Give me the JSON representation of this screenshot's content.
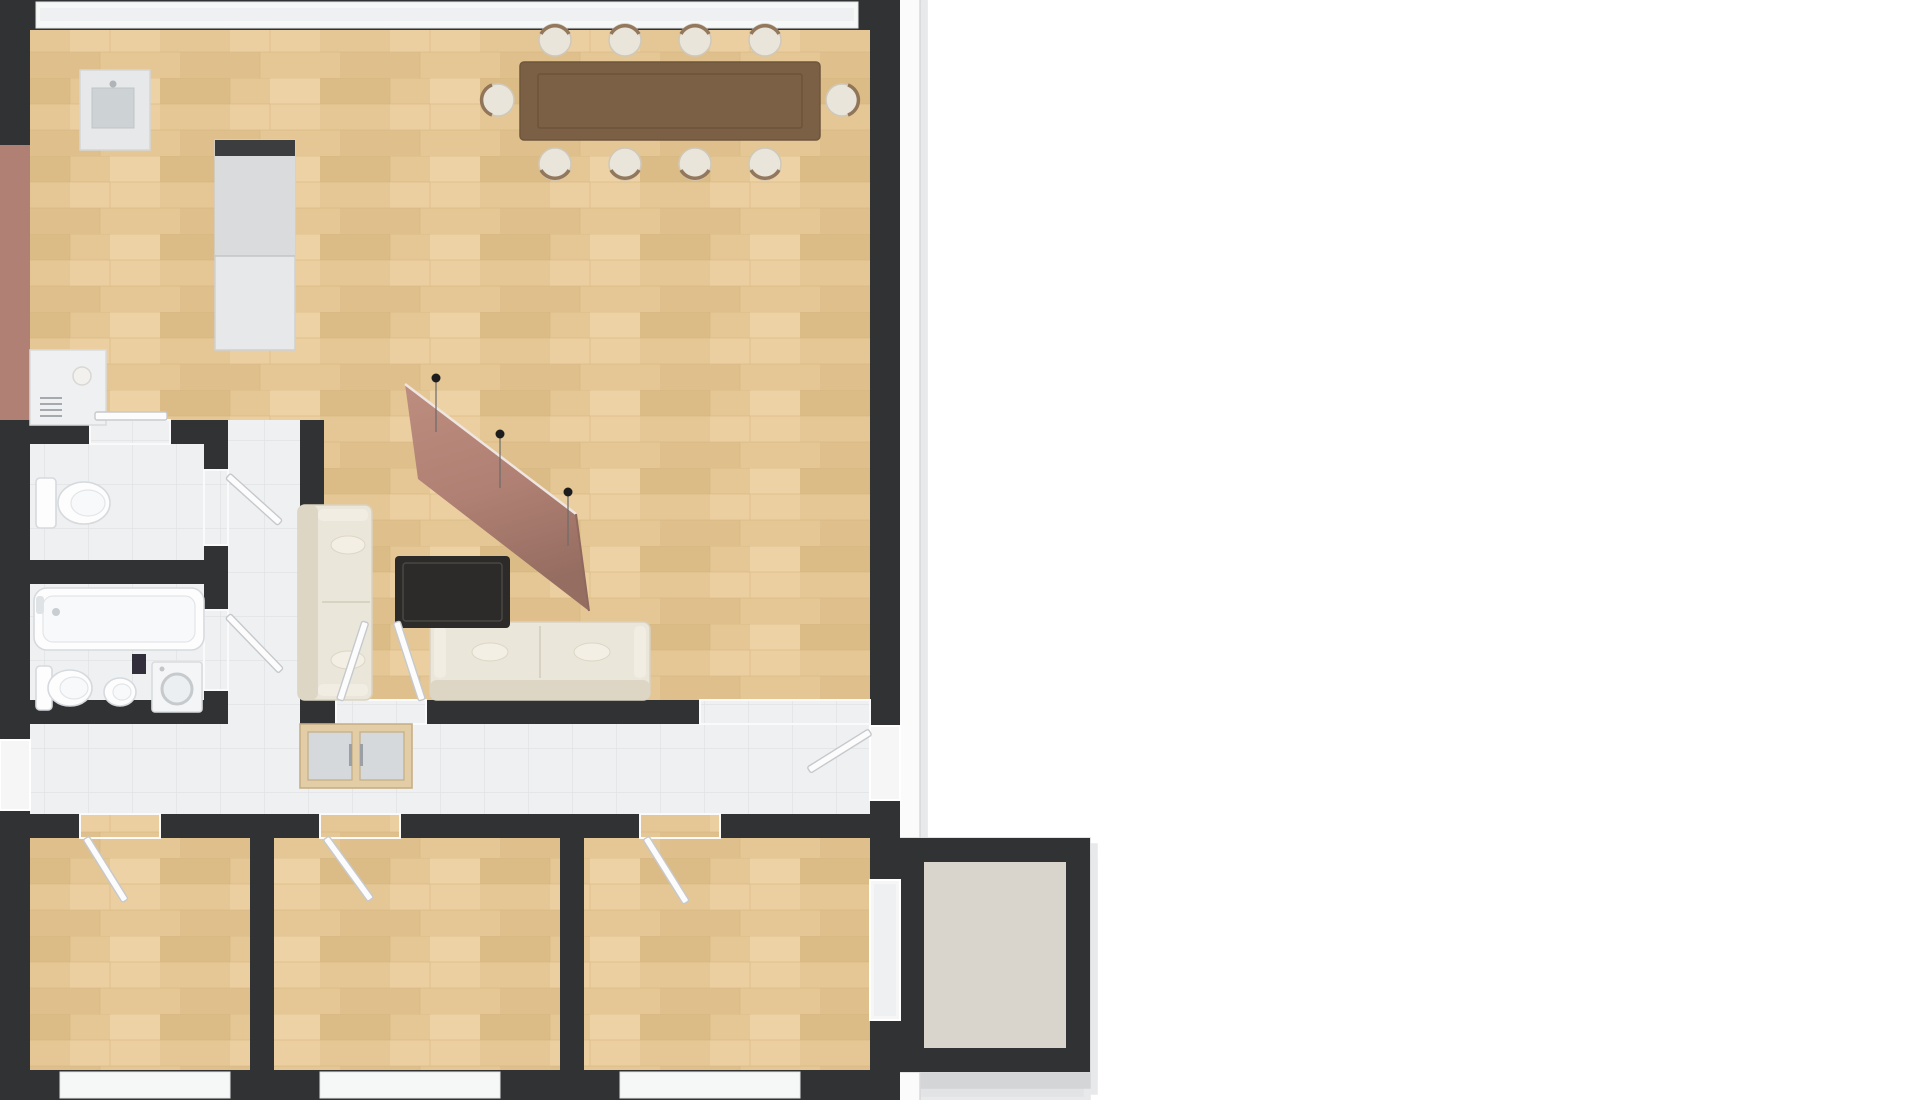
{
  "scene": {
    "kind": "3d-floor-plan-render",
    "view": "isometric aerial, rotated ~40deg, white background",
    "apartment": "3-bedroom apartment with open living-dining room, galley kitchen, bathroom, WC, hallway and balcony"
  },
  "colors": {
    "background": "#ffffff",
    "slab": "#fbfbfb",
    "slab_edge": "#d9dadb",
    "wall": "#313234",
    "wood": "#e4c795",
    "wood_dark": "#d9b981",
    "wood_light": "#efd8ac",
    "tile": "#eef0f1",
    "tile_line": "#e0e3e5",
    "concrete": "#d9d5cd",
    "accent": "#af8073",
    "accent_dark": "#8f685e",
    "accent_light": "#bd8d7f",
    "table": "#7c6045",
    "table_edge": "#665037",
    "chair": "#e9e5da",
    "chair_trim": "#8a6d50",
    "sofa": "#ebe6da",
    "sofa_trim": "#d7d0bf",
    "coffee_table": "#2d2b29",
    "wardrobe": "#e2cda6",
    "wardrobe_trim": "#c7af85",
    "frosted_glass": "#d5d9dc",
    "cabinet": "#e7e8e9",
    "cabinet_dark": "#3c3d3f",
    "fixture": "#fdfdfe",
    "fixture_line": "#d6dade",
    "washer": "#f4f5f6",
    "washer_ring": "#c6cacd",
    "bin": "#332e3c",
    "door": "#fcfcfd",
    "door_edge": "#c6c9cc",
    "frame": "#ffffff",
    "frame_edge": "#d2d4d6",
    "glass": "#ece6da",
    "glass_cool": "#eef0f1",
    "pendant": "#1d1d1d"
  },
  "rooms": [
    {
      "id": "living-dining",
      "floor": "wood"
    },
    {
      "id": "kitchen",
      "floor": "wood",
      "feature": "mauve accent wall"
    },
    {
      "id": "corridor",
      "floor": "tile"
    },
    {
      "id": "wc",
      "floor": "tile"
    },
    {
      "id": "bathroom",
      "floor": "tile"
    },
    {
      "id": "hallway",
      "floor": "tile"
    },
    {
      "id": "bedroom-west",
      "floor": "wood"
    },
    {
      "id": "bedroom-middle",
      "floor": "wood"
    },
    {
      "id": "bedroom-east",
      "floor": "wood"
    },
    {
      "id": "balcony",
      "floor": "concrete"
    }
  ],
  "furniture": [
    "dining-table",
    "dining-chairs",
    "sofa-long",
    "sofa-short",
    "coffee-table",
    "wardrobe",
    "kitchen-counter",
    "kitchen-island",
    "kitchen-tall-cabinets",
    "bathtub",
    "wc-toilet",
    "bath-toilet",
    "bidet",
    "washing-machine",
    "trash-bin"
  ],
  "counts": {
    "dining_chairs": 10,
    "pendant_lights": 3,
    "north_window_panels": 12,
    "south_window_groups": 3,
    "panes_per_south_group": 3,
    "balcony_window_panes": 2,
    "interior_door_leaves": 8
  },
  "window_geometry": {
    "north_band": {
      "u0": 40,
      "u1": 858,
      "lean": [
        -40,
        -60
      ]
    },
    "south_groups": [
      {
        "u0": 60,
        "u1": 230,
        "panes": 3
      },
      {
        "u0": 320,
        "u1": 500,
        "panes": 3
      },
      {
        "u0": 620,
        "u1": 800,
        "panes": 3
      }
    ],
    "south_lean": [
      25,
      -105
    ],
    "balcony_window": {
      "v0": 880,
      "v1": 1020,
      "u": 886,
      "panes": 2,
      "lean": [
        30,
        -95
      ]
    }
  },
  "pendants": [
    {
      "x": 436,
      "y": 378
    },
    {
      "x": 500,
      "y": 434
    },
    {
      "x": 568,
      "y": 492
    }
  ],
  "accent_wall_quad": "418,479 405,384 576,514 589,611",
  "homography": {
    "plan_corners": [
      [
        0,
        0
      ],
      [
        900,
        0
      ],
      [
        900,
        1100
      ],
      [
        0,
        1100
      ]
    ],
    "screen_corners": [
      [
        336,
        414
      ],
      [
        855,
        60
      ],
      [
        1518,
        528
      ],
      [
        1014,
        1035
      ]
    ]
  }
}
